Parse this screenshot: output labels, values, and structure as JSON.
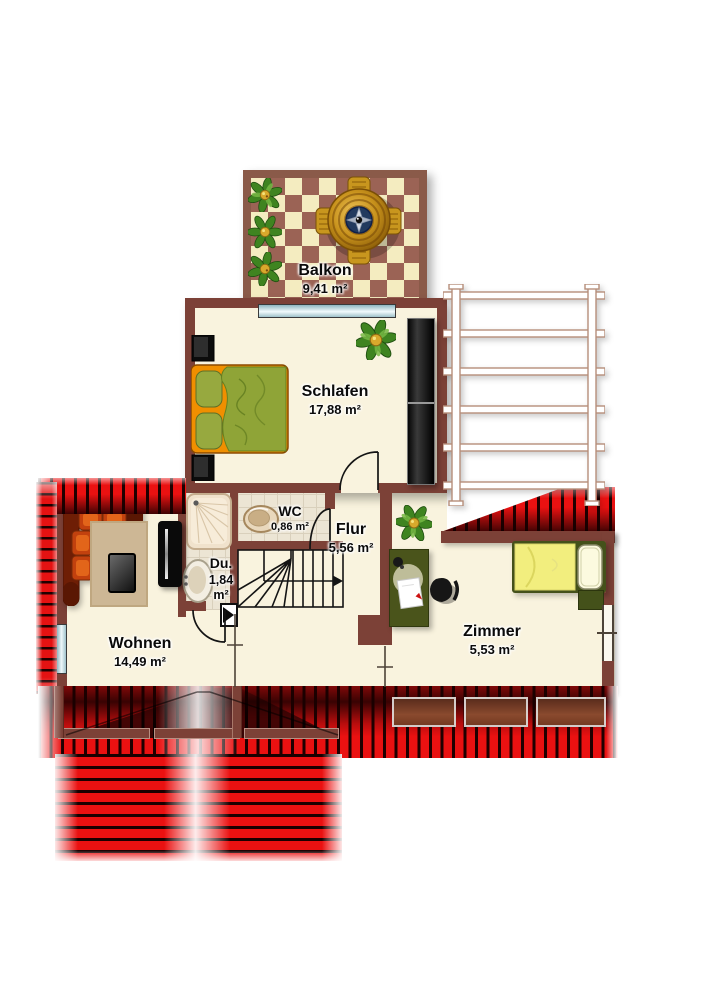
{
  "rooms": {
    "balkon": {
      "label": "Balkon",
      "area": "9,41 m²"
    },
    "schlafen": {
      "label": "Schlafen",
      "area": "17,88 m²"
    },
    "wc": {
      "label": "WC",
      "area": "0,86 m²"
    },
    "dusche": {
      "label": "Du.",
      "area_value": "1,84",
      "area_unit": "m²"
    },
    "flur": {
      "label": "Flur",
      "area": "5,56 m²"
    },
    "wohnen": {
      "label": "Wohnen",
      "area": "14,49 m²"
    },
    "zimmer": {
      "label": "Zimmer",
      "area": "5,53 m²"
    }
  },
  "colors": {
    "wall": "#7c4137",
    "floor": "#f9f3de",
    "checker_brown": "#9b6355",
    "checker_cream": "#f4ecc0",
    "roof_red": "#ea1111",
    "roof_stripe_dark": "#200000",
    "glass_blue": "#bcd8e0",
    "trellis_line": "#b68e7a"
  }
}
